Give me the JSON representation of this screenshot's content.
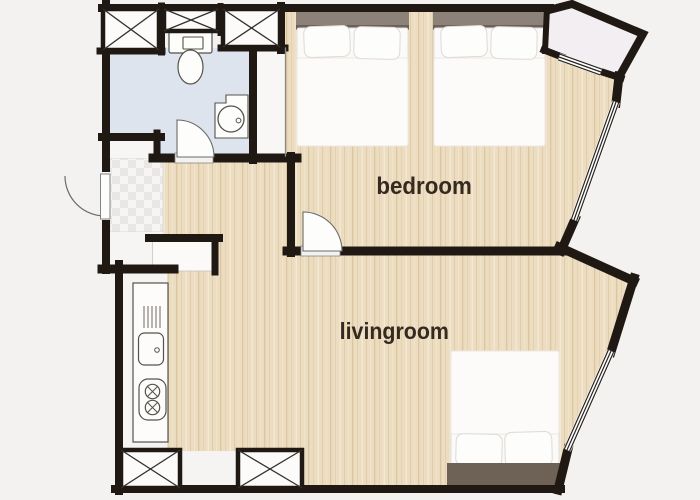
{
  "floor_plan": {
    "labels": {
      "bedroom": "bedroom",
      "livingroom": "livingroom"
    },
    "rooms": {
      "bedroom": {
        "label": "bedroom",
        "furniture": [
          "double-bed",
          "double-bed",
          "wardrobe-closet"
        ]
      },
      "livingroom": {
        "label": "livingroom",
        "furniture": [
          "double-bed",
          "kitchen-counter",
          "sink",
          "two-burner-stove",
          "storage-closet",
          "storage-closet"
        ]
      },
      "bathroom": {
        "furniture": [
          "toilet",
          "round-washbasin",
          "storage-closet",
          "storage-closet",
          "storage-closet"
        ]
      },
      "entry": {
        "furniture": [
          "entry-door",
          "tiled-floor"
        ]
      },
      "balcony": {}
    },
    "doors": [
      "entry-door",
      "bathroom-door",
      "bedroom-door"
    ],
    "windows": [
      "balcony-window",
      "bedroom-window",
      "livingroom-window"
    ],
    "colors": {
      "wall": "#201913",
      "wood_floor": "#ecdcc0",
      "bathroom_floor": "#dee4ed",
      "balcony_floor": "#f2eef1",
      "background": "#f4f2f0",
      "bed_headboard": "#8d8279",
      "livingroom_bed_headboard": "#6e6257",
      "label_text": "#352a20"
    }
  }
}
